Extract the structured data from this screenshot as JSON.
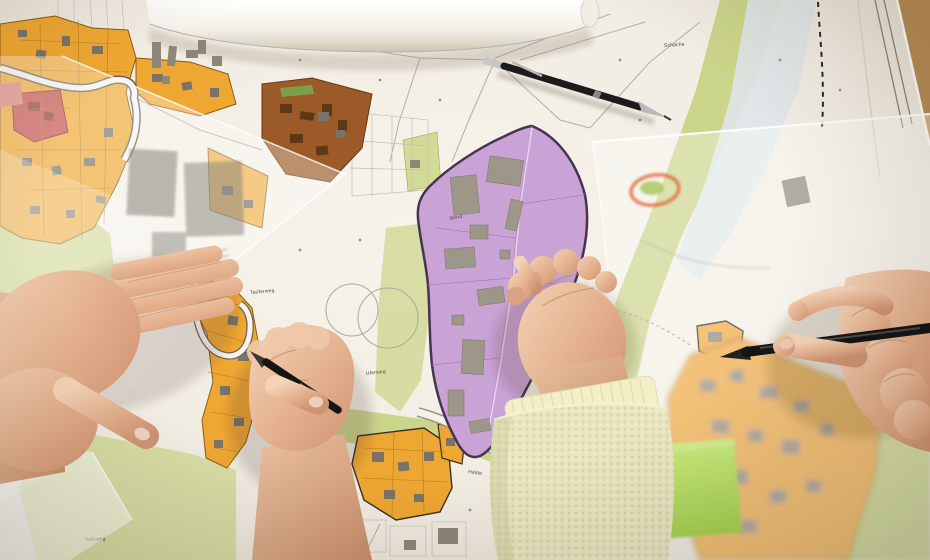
{
  "scene": {
    "type": "photograph",
    "description": "Overhead photo of a planning workshop: four hands work over colored municipal zoning maps with tracing-paper overlays, two mechanical pencils, a black pen, a rolled plan sheet and a green sticky note on a wooden table."
  },
  "map_labels": {
    "schache": "Schache",
    "werd": "Werd",
    "uferweg": "Uferweg",
    "halde": "Halde",
    "holzweg": "holzweg",
    "tauferweg": "Tauferweg"
  },
  "colors": {
    "residential_orange": "#efa733",
    "mixed_use_brown": "#9c5a28",
    "industrial_purple": "#c9a2d6",
    "green_space": "#cbd58a",
    "special_zone_red": "#c8504a",
    "water_blue": "#dfe5e8",
    "sticky_note_green": "#bce26a",
    "paper_white": "#f4f0e8",
    "table_wood": "#b98d55",
    "annotation_red": "#e0683c"
  },
  "objects": {
    "paper_roll": "rolled plan sheet",
    "pencil_top": "mechanical pencil",
    "pencil_in_fist": "mechanical pencil held in fist",
    "pen_right": "black pen",
    "sticky_note": "green sticky note",
    "overlay_left": "tracing-paper overlay",
    "overlay_right": "tracing-paper overlay",
    "hand_left": "left hand pressing overlay",
    "hand_fist": "fist writing with pencil",
    "hand_center": "hand touching map",
    "hand_right": "hand pointing with pen"
  }
}
